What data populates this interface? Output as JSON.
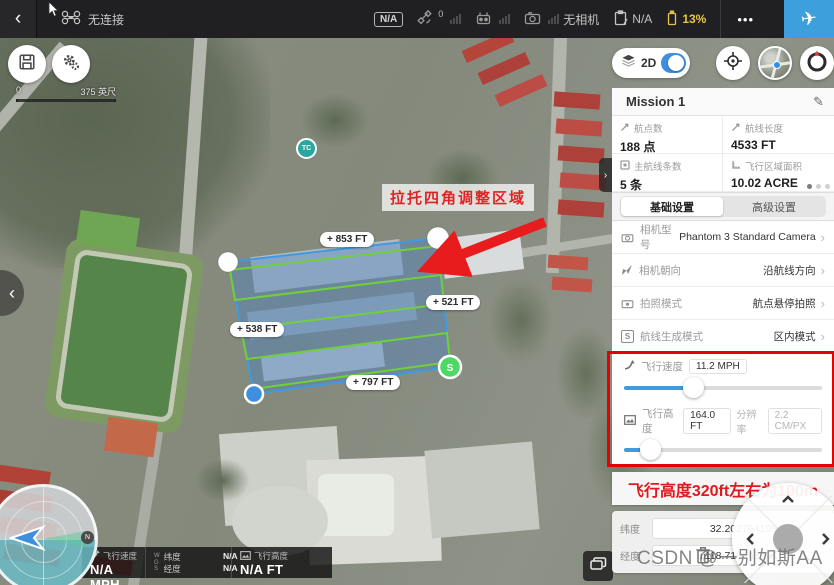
{
  "topbar": {
    "connection": "无连接",
    "flight_mode_badge": "N/A",
    "gps_count": "0",
    "camera_status": "无相机",
    "status_value": "N/A",
    "battery_percent": "13%"
  },
  "map_controls": {
    "view_toggle_label": "2D",
    "scale_start": "0",
    "scale_end": "375 英尺"
  },
  "map": {
    "annotation_text": "拉托四角调整区域",
    "edge_labels": {
      "top": "+ 853 FT",
      "right": "+ 521 FT",
      "left": "+ 538 FT",
      "bottom": "+ 797 FT"
    },
    "start_marker": "S",
    "poi_marker": "TC",
    "compass_north": "N"
  },
  "panel": {
    "title": "Mission 1",
    "stats": [
      {
        "label": "航点数",
        "value": "188 点"
      },
      {
        "label": "航线长度",
        "value": "4533 FT"
      },
      {
        "label": "主航线条数",
        "value": "5 条"
      },
      {
        "label": "飞行区域面积",
        "value": "10.02 ACRE"
      }
    ],
    "tabs": [
      {
        "label": "基础设置"
      },
      {
        "label": "高级设置"
      }
    ],
    "settings": [
      {
        "label": "相机型号",
        "value": "Phantom 3 Standard Camera"
      },
      {
        "label": "相机朝向",
        "value": "沿航线方向"
      },
      {
        "label": "拍照模式",
        "value": "航点悬停拍照"
      },
      {
        "label": "航线生成模式",
        "value": "区内模式",
        "icon_letter": "S"
      }
    ],
    "speed": {
      "label": "飞行速度",
      "value": "11.2 MPH"
    },
    "altitude": {
      "label": "飞行高度",
      "value": "164.0 FT",
      "resolution_label": "分辨率",
      "resolution_value": "2.2 CM/PX"
    },
    "note": "飞行高度320ft左右为100m",
    "coords": {
      "lat_label": "纬度",
      "lat_value": "32.202764195",
      "lng_label": "经度",
      "lng_value": "118.716763493"
    }
  },
  "telemetry": {
    "speed_label": "飞行速度",
    "speed_value": "N/A MPH",
    "wgs": "WGS",
    "lat_label": "纬度",
    "lat_value": "N/A",
    "lng_label": "经度",
    "lng_value": "N/A",
    "alt_label": "飞行高度",
    "alt_value": "N/A FT"
  },
  "watermark": "CSDN @一别如斯AA",
  "icons": {
    "back_chevron": "‹",
    "chevron_left": "‹",
    "chevron_right": "›",
    "pencil": "✎",
    "plane": "✈",
    "more_dots": "•••"
  },
  "colors": {
    "accent_blue": "#3da0dc",
    "toggle_blue": "#3f8fe0",
    "battery_yellow": "#e7c545",
    "annotation_red": "#e60000",
    "route_green": "#6fd138",
    "polygon_blue": "#3f9be0"
  }
}
